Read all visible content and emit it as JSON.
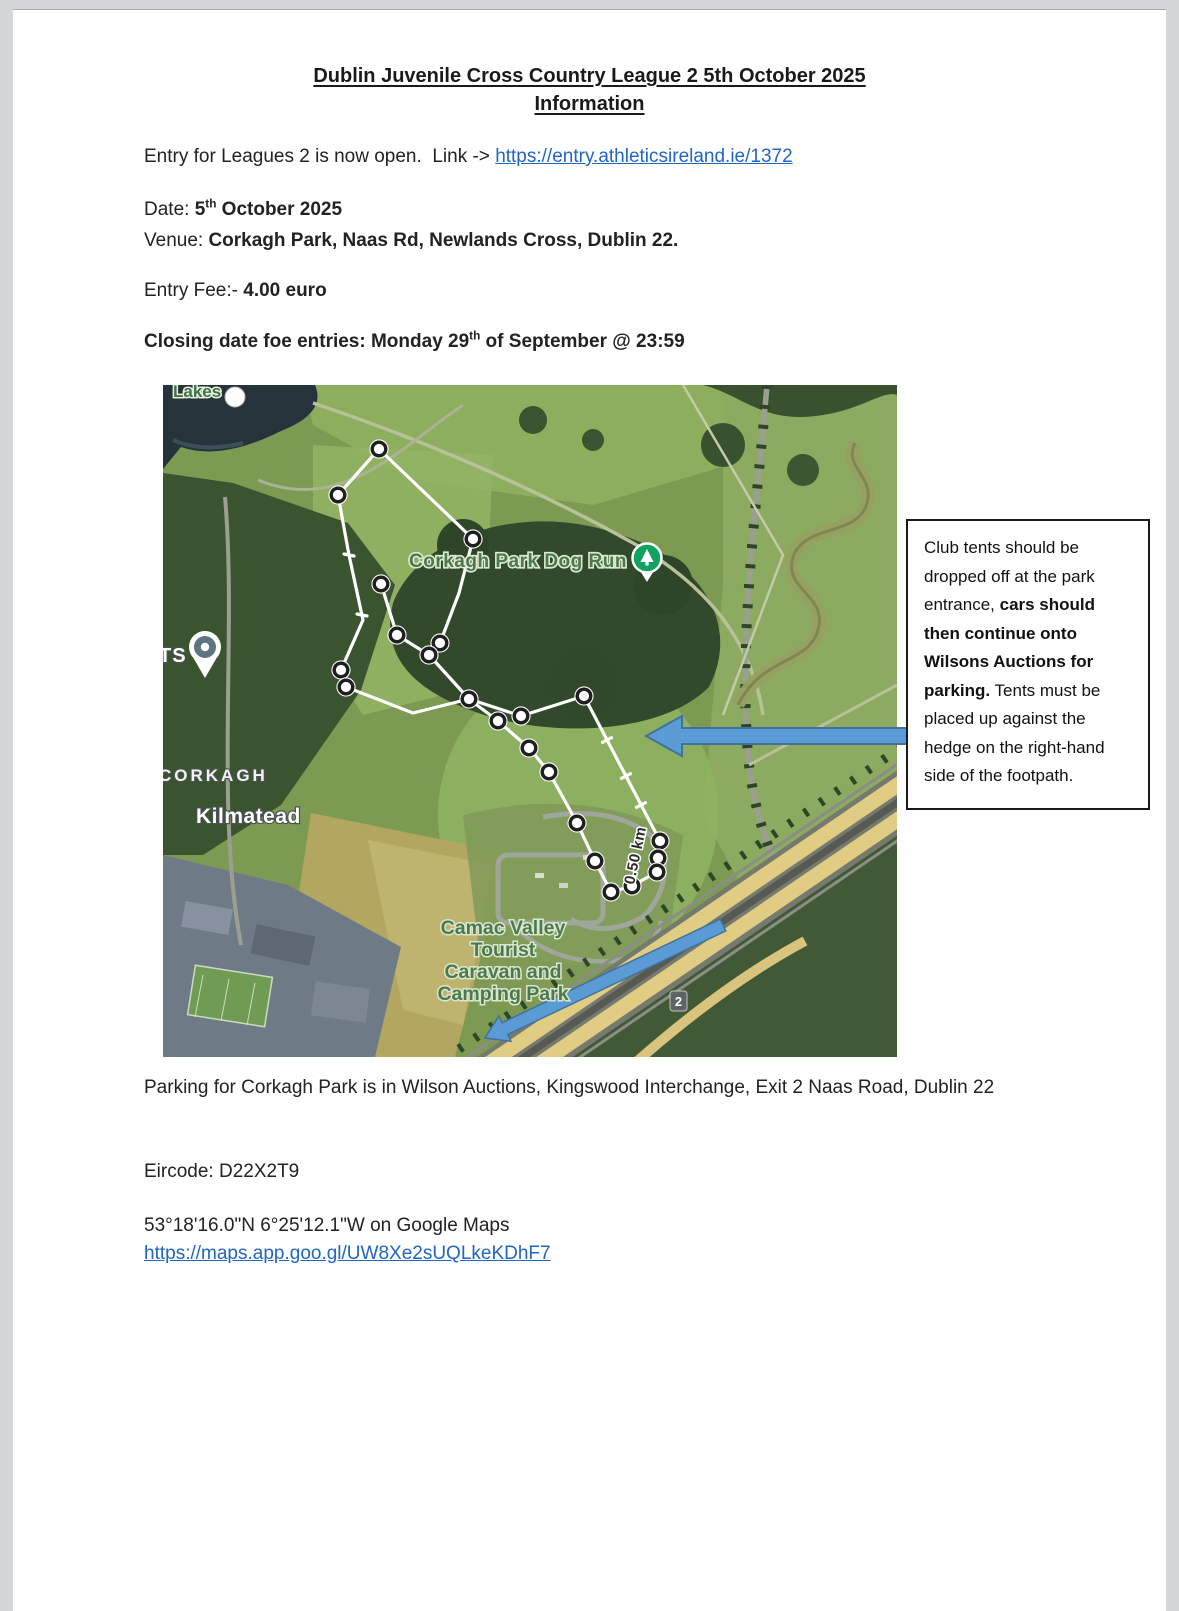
{
  "page": {
    "title_line1": "Dublin Juvenile Cross Country League 2 5th October 2025",
    "title_line2": "Information",
    "entry": {
      "prefix": "Entry for Leagues 2 is now open.  Link -> ",
      "link": "https://entry.athleticsireland.ie/1372"
    },
    "details": {
      "date_label": "Date: ",
      "date_day": "5",
      "date_ord": "th",
      "date_rest": " October 2025",
      "venue_label": "Venue: ",
      "venue_value": "Corkagh Park, Naas Rd, Newlands Cross, Dublin 22.",
      "fee_label": "Entry Fee:- ",
      "fee_value": "4.00 euro",
      "closing_prefix": "Closing date foe entries: Monday 29",
      "closing_ord": "th",
      "closing_suffix": " of September @ 23:59"
    },
    "map": {
      "labels": {
        "partial_top": "Lakes",
        "dog_run": "Corkagh Park Dog Run",
        "ts": "TS",
        "corkagh": "CORKAGH",
        "kilmatead": "Kilmatead",
        "camac_line1": "Camac Valley",
        "camac_line2": "Tourist",
        "camac_line3": "Caravan and",
        "camac_line4": "Camping Park",
        "distance": "0.50 km",
        "junction": "2"
      }
    },
    "note_box": {
      "normal1": "Club tents should be dropped off at the park entrance, ",
      "bold1": "cars should then continue onto Wilsons Auctions for parking.",
      "normal2": " Tents must be placed up against the hedge on the right-hand side of the footpath."
    },
    "footer": {
      "parking": "Parking for Corkagh Park is in Wilson Auctions, Kingswood Interchange, Exit 2 Naas Road, Dublin 22",
      "eircode": "Eircode: D22X2T9",
      "coords": "53°18'16.0\"N 6°25'12.1\"W on Google Maps",
      "maps_link": "https://maps.app.goo.gl/UW8Xe2sUQLkeKDhF7"
    },
    "colors": {
      "link_blue": "#2166c4",
      "arrow_fill": "#5b9bd5",
      "arrow_stroke": "#41719c",
      "map_label_green": "#41714a",
      "pin_green": "#10a25e",
      "pin_slate": "#5d7482"
    }
  }
}
